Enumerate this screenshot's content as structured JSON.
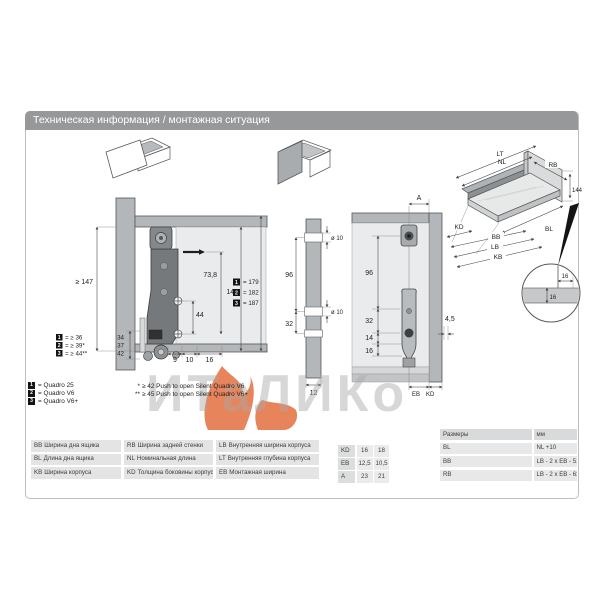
{
  "header": {
    "title": "Техническая информация / монтажная ситуация"
  },
  "watermark": {
    "text": "ИТаЛИКо",
    "flame_color": "#e2612d"
  },
  "left_drawing": {
    "dim_min_height": "≥ 147",
    "dim_738": "73,8",
    "dim_144": "144",
    "dim_44": "44",
    "dim_9": "9",
    "dim_10": "10",
    "dim_16": "16",
    "heights": [
      {
        "badge": "1",
        "value": "= 179"
      },
      {
        "badge": "2",
        "value": "= 182"
      },
      {
        "badge": "3",
        "value": "= 187"
      }
    ],
    "front_gaps": [
      {
        "badge": "1",
        "value": "= ≥ 36",
        "dim": "34"
      },
      {
        "badge": "2",
        "value": "= ≥ 39*",
        "dim": "37"
      },
      {
        "badge": "3",
        "value": "= ≥ 44**",
        "dim": "42"
      }
    ]
  },
  "middle_drawing": {
    "dim_hole_top": "ø 10",
    "dim_96": "96",
    "dim_hole_mid": "ø 10",
    "dim_32": "32",
    "dim_12": "12"
  },
  "right_drawing": {
    "dim_a": "A",
    "dim_96": "96",
    "dim_32": "32",
    "dim_14": "14",
    "dim_16": "16",
    "dim_45": "4,5",
    "label_eb": "EB",
    "label_kd": "KD"
  },
  "iso_drawing": {
    "lt": "LT",
    "nl": "NL",
    "rb": "RB",
    "h144": "144",
    "bl": "BL",
    "kd": "KD",
    "bb": "BB",
    "lb": "LB",
    "kb": "KB"
  },
  "detail_view": {
    "dim_h": "16",
    "dim_v": "16"
  },
  "legend": [
    {
      "badge": "1",
      "label": "= Quadro 25"
    },
    {
      "badge": "2",
      "label": "= Quadro V6"
    },
    {
      "badge": "3",
      "label": "= Quadro V6+"
    }
  ],
  "footnotes": [
    {
      "mark": "*",
      "text": "≥ 42 Push to open Silent Quadro V6"
    },
    {
      "mark": "**",
      "text": "≥ 45 Push to open Silent Quadro V6+"
    }
  ],
  "tables": {
    "abbreviations": {
      "rows": [
        [
          {
            "code": "BB",
            "desc": "Ширина дна ящика"
          },
          {
            "code": "RB",
            "desc": "Ширина задней стенки"
          },
          {
            "code": "LB",
            "desc": "Внутренняя ширина корпуса"
          }
        ],
        [
          {
            "code": "BL",
            "desc": "Длина дна ящика"
          },
          {
            "code": "NL",
            "desc": "Номинальная длина"
          },
          {
            "code": "LT",
            "desc": "Внутренняя глубина корпуса"
          }
        ],
        [
          {
            "code": "KB",
            "desc": "Ширина корпуса"
          },
          {
            "code": "KD",
            "desc": "Толщина боковины корпуса"
          },
          {
            "code": "EB",
            "desc": "Монтажная ширина"
          }
        ]
      ]
    },
    "values": {
      "rows": [
        {
          "label": "KD",
          "v1": "16",
          "v2": "18"
        },
        {
          "label": "EB",
          "v1": "12,5",
          "v2": "10,5"
        },
        {
          "label": "A",
          "v1": "23",
          "v2": "21"
        }
      ]
    },
    "formulas": {
      "header": {
        "col1": "Размеры",
        "col2": "мм"
      },
      "rows": [
        {
          "label": "BL",
          "formula": "NL +10"
        },
        {
          "label": "BB",
          "formula": "LB - 2 x EB - 51,5"
        },
        {
          "label": "RB",
          "formula": "LB - 2 x EB - 63"
        }
      ]
    }
  },
  "colors": {
    "header_bg": "#97989a",
    "accent_flame": "#e2612d",
    "panel_gray": "#b4b7b9",
    "profile_dark": "#75797c"
  }
}
